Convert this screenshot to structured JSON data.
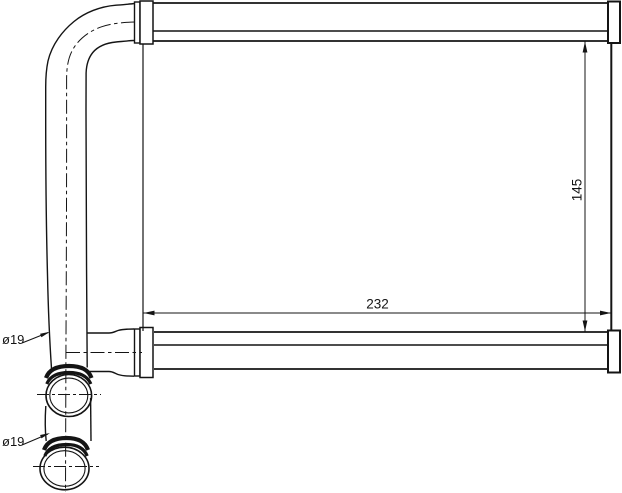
{
  "drawing": {
    "kind": "heater-core-technical-drawing",
    "dimensions": {
      "core_width": "232",
      "core_height": "145",
      "inlet_pipe_diameter": "ø19",
      "outlet_pipe_diameter": "ø19"
    },
    "colors": {
      "line": "#141414",
      "background": "#ffffff"
    }
  }
}
